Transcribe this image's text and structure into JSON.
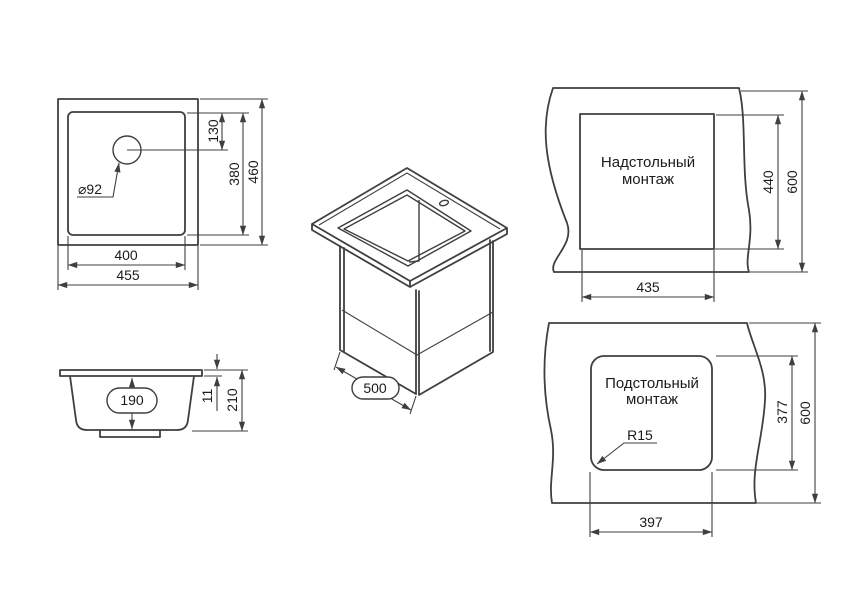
{
  "meta": {
    "background_color": "#ffffff",
    "line_color": "#3f3f3f",
    "text_color": "#1b1b1b",
    "drawing_type": "sink installation dimensions"
  },
  "views": {
    "plan": {
      "dims": {
        "outer_width": "455",
        "inner_width": "400",
        "outer_height": "460",
        "inner_height": "380",
        "hole_offset": "130",
        "hole_diameter": "⌀92"
      }
    },
    "section": {
      "dims": {
        "bowl_depth": "190",
        "rim_height": "11",
        "total_height": "210"
      }
    },
    "iso": {
      "dims": {
        "cabinet_depth": "500"
      }
    },
    "topmount": {
      "title1": "Надстольный",
      "title2": "монтаж",
      "dims": {
        "cutout_width": "435",
        "cutout_height": "440",
        "counter_depth": "600"
      }
    },
    "undermount": {
      "title1": "Подстольный",
      "title2": "монтаж",
      "dims": {
        "cutout_width": "397",
        "cutout_height": "377",
        "counter_depth": "600",
        "corner_radius": "R15"
      }
    }
  }
}
